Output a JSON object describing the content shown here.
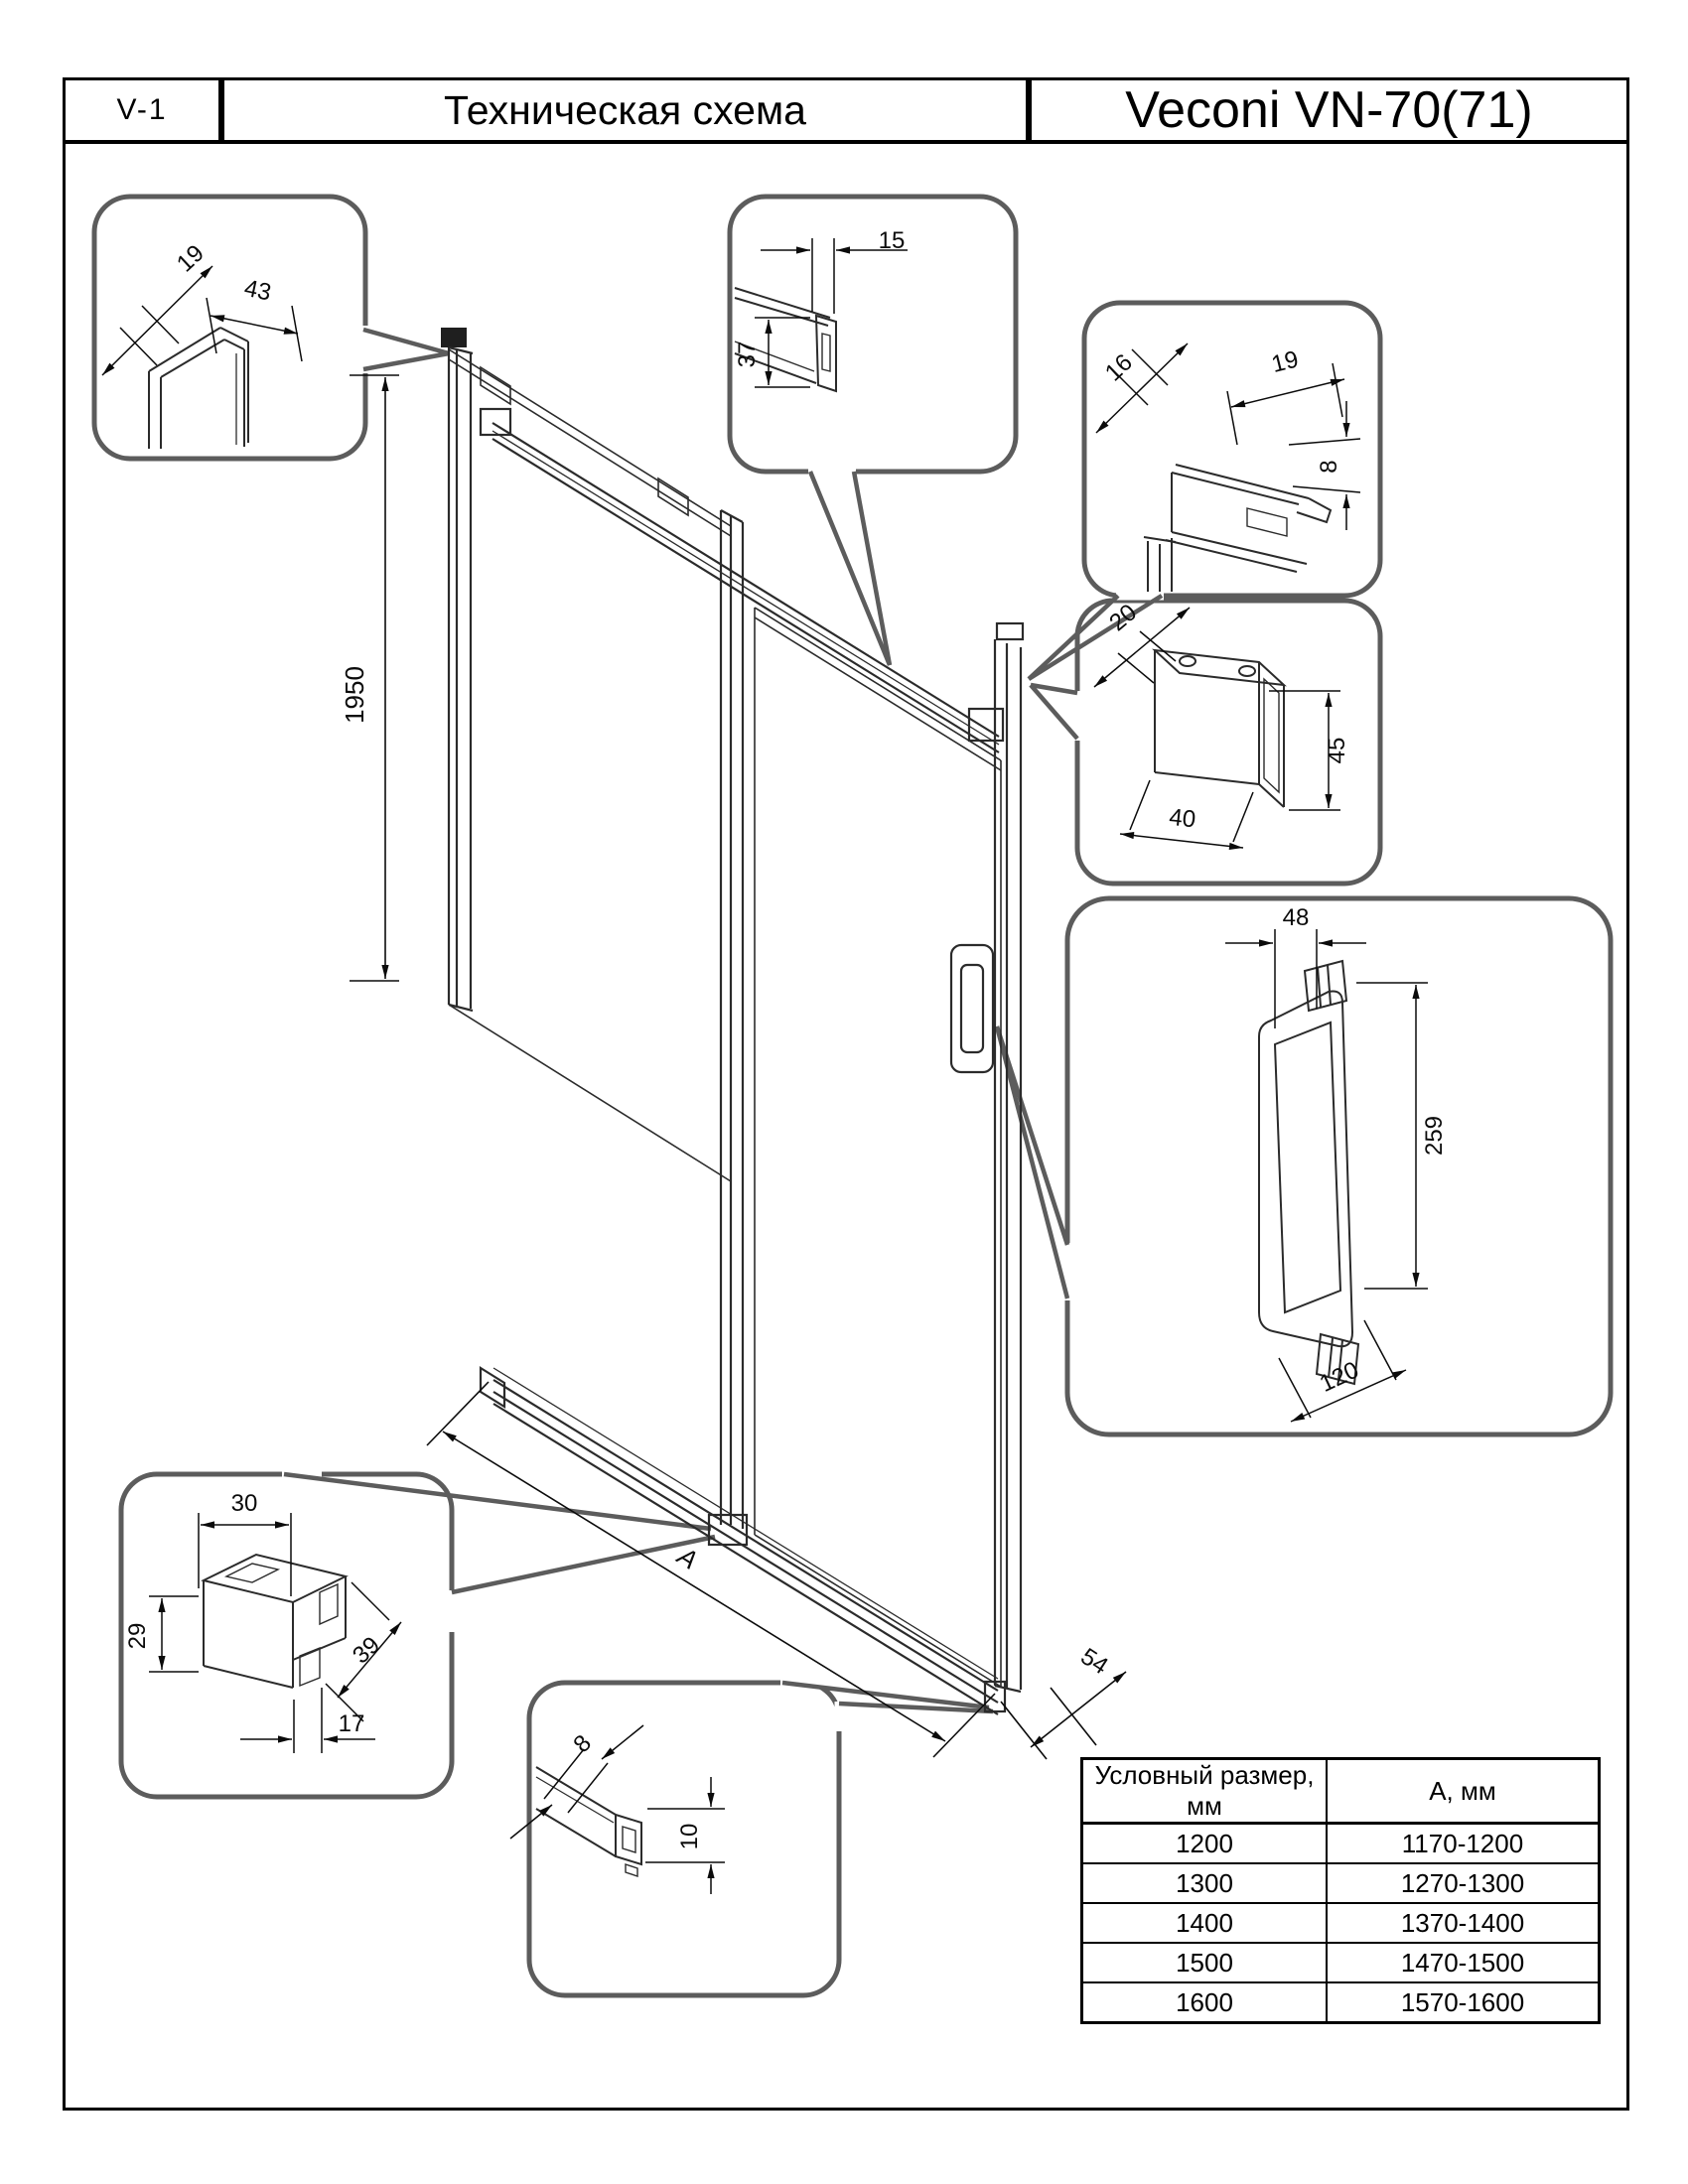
{
  "header": {
    "code": "V-1",
    "title": "Техническая схема",
    "brand": "Veconi VN-70(71)"
  },
  "drawing": {
    "height": "1950",
    "width_label": "A",
    "rail_depth": "54",
    "wall_profile": {
      "depth": "19",
      "width": "43"
    },
    "top_rail": {
      "width": "15",
      "height": "37"
    },
    "seal": {
      "d1": "16",
      "d2": "19",
      "d3": "8"
    },
    "bracket": {
      "depth": "20",
      "height": "45",
      "width": "40"
    },
    "handle": {
      "width": "48",
      "height": "259",
      "length": "120"
    },
    "roller": {
      "top": "30",
      "side": "29",
      "diag": "39",
      "bottom": "17"
    },
    "guide": {
      "side": "8",
      "height": "10"
    }
  },
  "table": {
    "header": [
      "Условный размер, мм",
      "А, мм"
    ],
    "rows": [
      [
        "1200",
        "1170-1200"
      ],
      [
        "1300",
        "1270-1300"
      ],
      [
        "1400",
        "1370-1400"
      ],
      [
        "1500",
        "1470-1500"
      ],
      [
        "1600",
        "1570-1600"
      ]
    ]
  }
}
